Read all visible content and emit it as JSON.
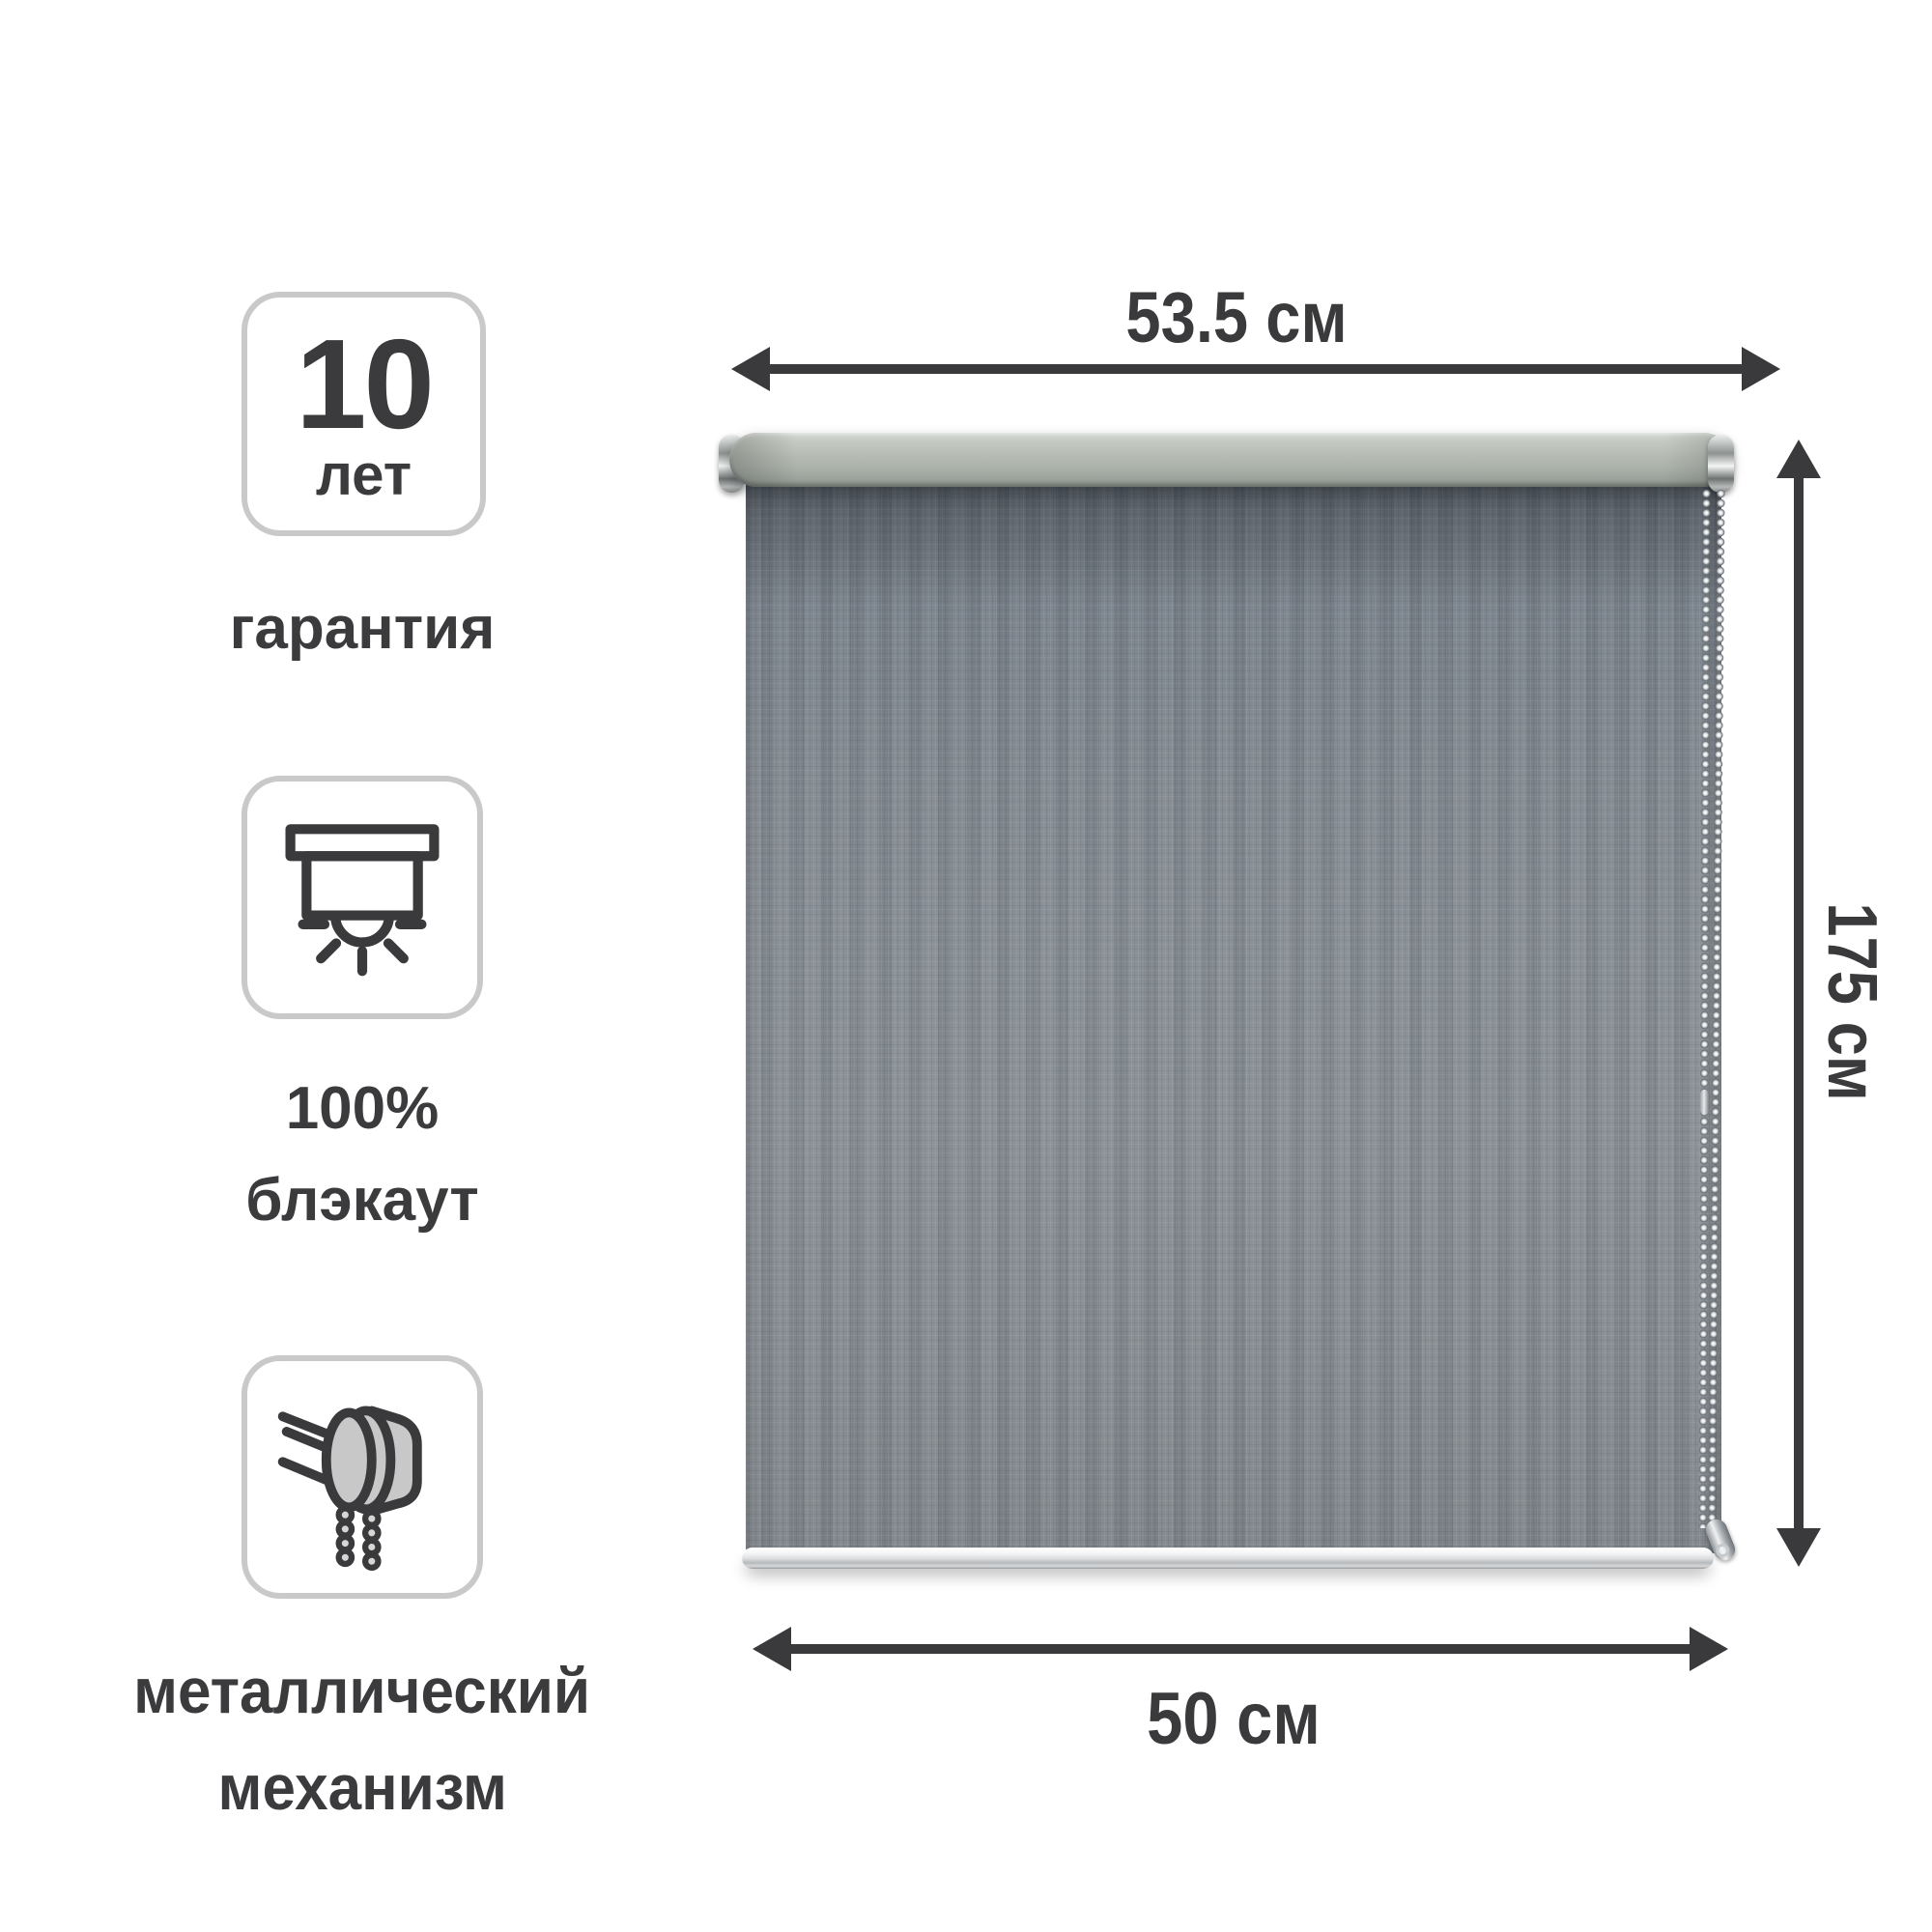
{
  "product": {
    "features": [
      {
        "icon": "warranty-10-years-badge",
        "badge_value": "10",
        "badge_unit": "лет",
        "label": "гарантия"
      },
      {
        "icon": "blackout-blind-icon",
        "label_line1": "100%",
        "label_line2": "блэкаут"
      },
      {
        "icon": "chain-mechanism-icon",
        "label_line1": "металлический",
        "label_line2": "механизм"
      }
    ],
    "dimensions": {
      "cassette_width": "53.5 см",
      "height": "175 см",
      "fabric_width": "50 см"
    },
    "colors": {
      "background": "#ffffff",
      "text": "#3b3b3d",
      "arrow": "#3a3a3c",
      "badge_border": "#c9c9c9",
      "cassette_tube": "#b6bcb4",
      "fabric_base": "#848b91",
      "icon_fill": "#c8c8c8",
      "bottom_bar": "#e8eaec"
    }
  }
}
